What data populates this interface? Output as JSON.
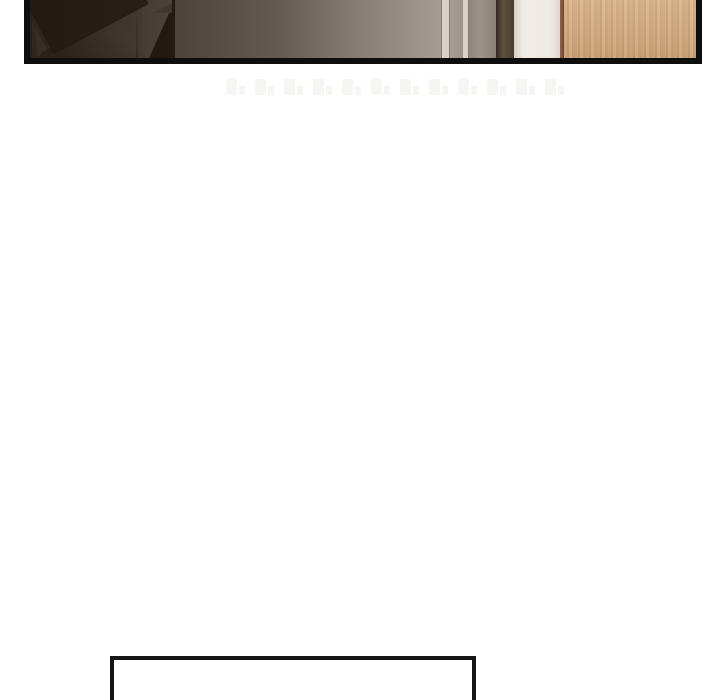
{
  "page": {
    "background": "#ffffff"
  },
  "comic_panel": {
    "scene": "apartment interior: hallway with ceiling light, stair railing, glass door frame, dark wardrobe, white wall and wooden cabinet",
    "border_color": "#0e0e0e"
  },
  "watermark": {
    "count": 12
  },
  "speech_box": {
    "border_color": "#151515",
    "fill": "#ffffff"
  },
  "colors": {
    "page_bg": "#ffffff",
    "panel_border": "#0e0e0e",
    "wall_dark": "#7d6a5d",
    "wall_mid": "#ac9e93",
    "wall_light": "#b6aca4",
    "hall_top": "#ecdfce",
    "hall_bottom": "#bfa98f",
    "ceiling_light": "#f5f1e8",
    "stair_wall_dark": "#8a7666",
    "stair_wall_light": "#9c8b7d",
    "rail": "#453527",
    "newel_dark": "#33281e",
    "newel_fill": "#8a796a",
    "frame_light": "#d8d2ca",
    "frame_edge": "#847a71",
    "glass_gray": "#a89e95",
    "door_gray": "#9c9289",
    "wardrobe_dark": "#473a2f",
    "wardrobe_mid": "#61513f",
    "white_wall": "#f0eae5",
    "cabinet_edge": "#6b4533",
    "wood_base": "#d3aa7d",
    "wood_dark": "#c89f72",
    "wood_light": "#dbb286",
    "watermark": "#f5f5f1",
    "speech_border": "#151515",
    "speech_fill": "#ffffff"
  }
}
